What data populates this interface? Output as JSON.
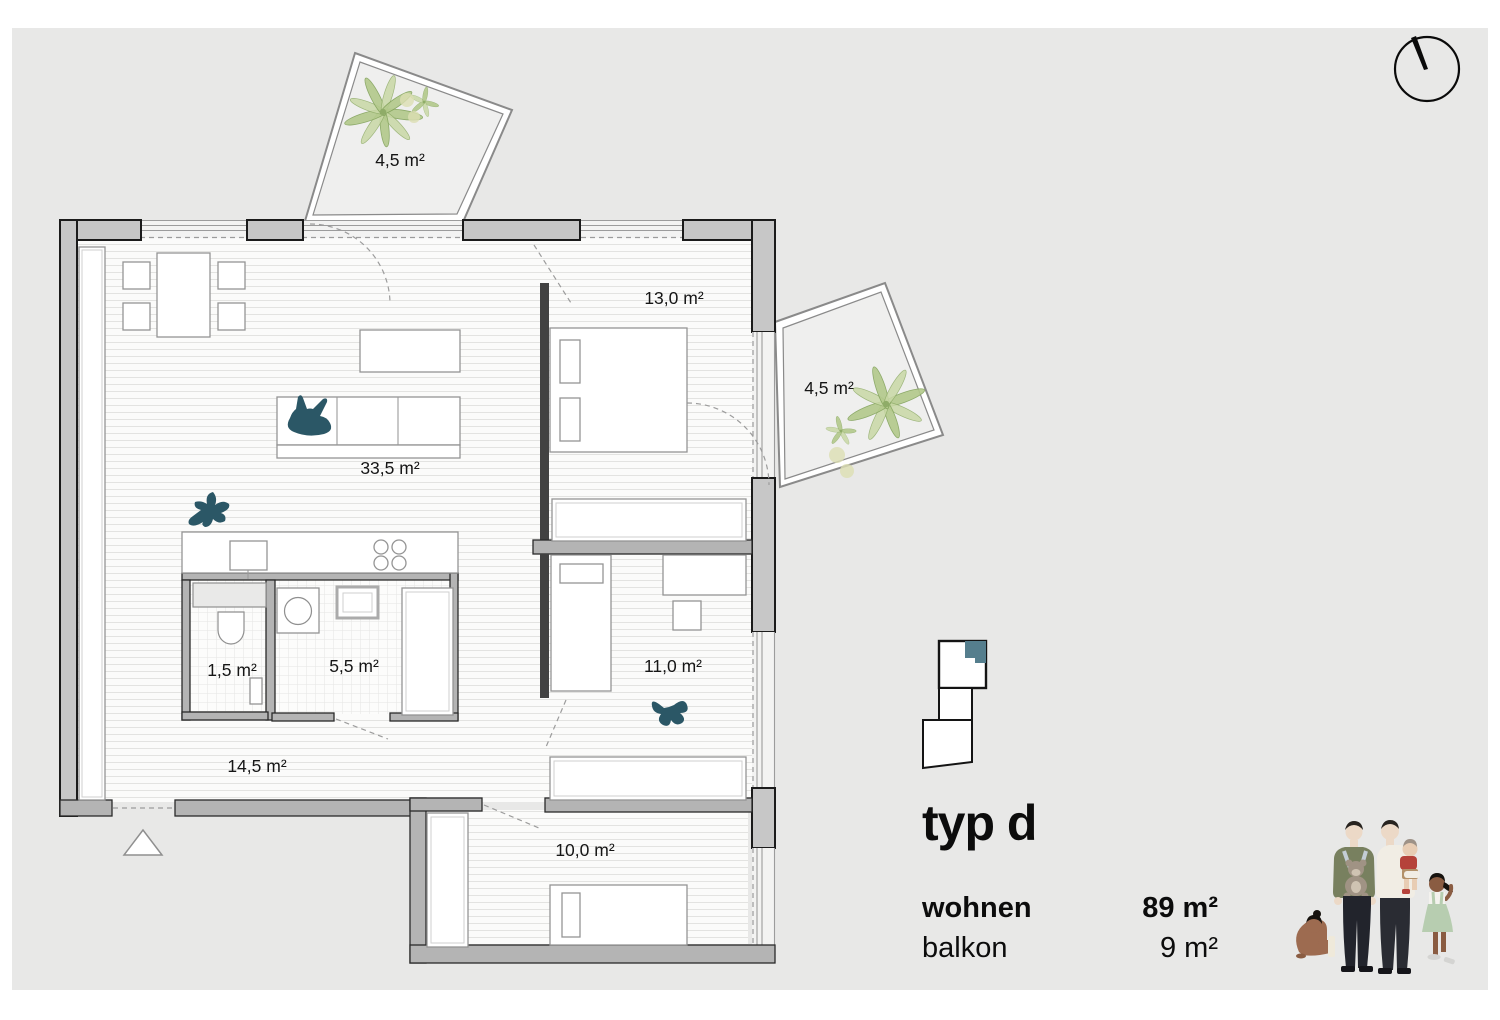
{
  "plan": {
    "labels": {
      "balcony_top": "4,5 m²",
      "bedroom": "13,0 m²",
      "balcony_right": "4,5 m²",
      "living": "33,5 m²",
      "wc": "1,5 m²",
      "bath": "5,5 m²",
      "kids_room": "11,0 m²",
      "hall": "14,5 m²",
      "bottom_room": "10,0 m²"
    }
  },
  "legend": {
    "title": "typ d",
    "rows": [
      {
        "label": "wohnen",
        "value": "89 m²"
      },
      {
        "label": "balkon",
        "value": "9 m²"
      }
    ]
  },
  "colors": {
    "canvas_gray": "#e8e8e7",
    "accent_teal": "#2b5766",
    "keyplan_highlight": "#557e8d",
    "plant_green": "#b3c98b",
    "wall_gray": "#c7c7c7"
  }
}
